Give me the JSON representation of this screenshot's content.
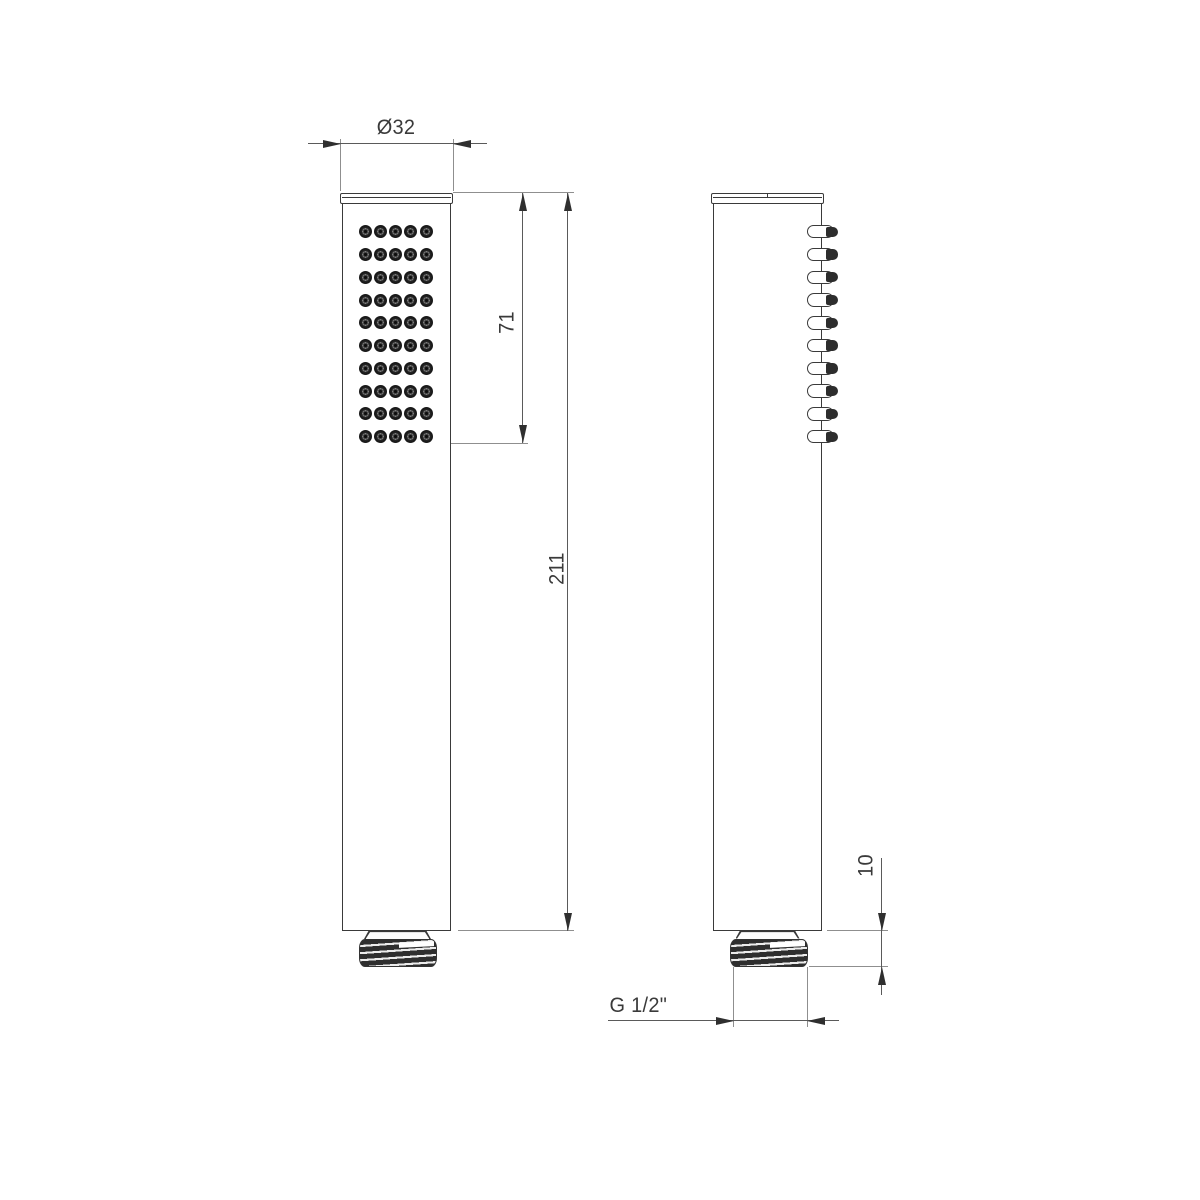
{
  "drawing": {
    "type": "technical-drawing",
    "subject": "handheld shower head, front and side orthographic views",
    "background": "#ffffff",
    "line_colors": {
      "outline": "#3a3a3a",
      "dimension_line": "#5a5a5a",
      "extension_line": "#8f8f8f",
      "arrow": "#2f2f2f",
      "text": "#3a3a3a"
    }
  },
  "dimensions": {
    "head_diameter": {
      "label": "Ø32"
    },
    "spray_face_length": {
      "label": "71"
    },
    "total_length": {
      "label": "211"
    },
    "thread_length": {
      "label": "10"
    },
    "thread_spec": {
      "label": "G 1/2\""
    }
  },
  "front_view": {
    "nozzle_grid": {
      "rows": 10,
      "cols": 5
    }
  },
  "side_view": {
    "nozzle_count": 10
  }
}
